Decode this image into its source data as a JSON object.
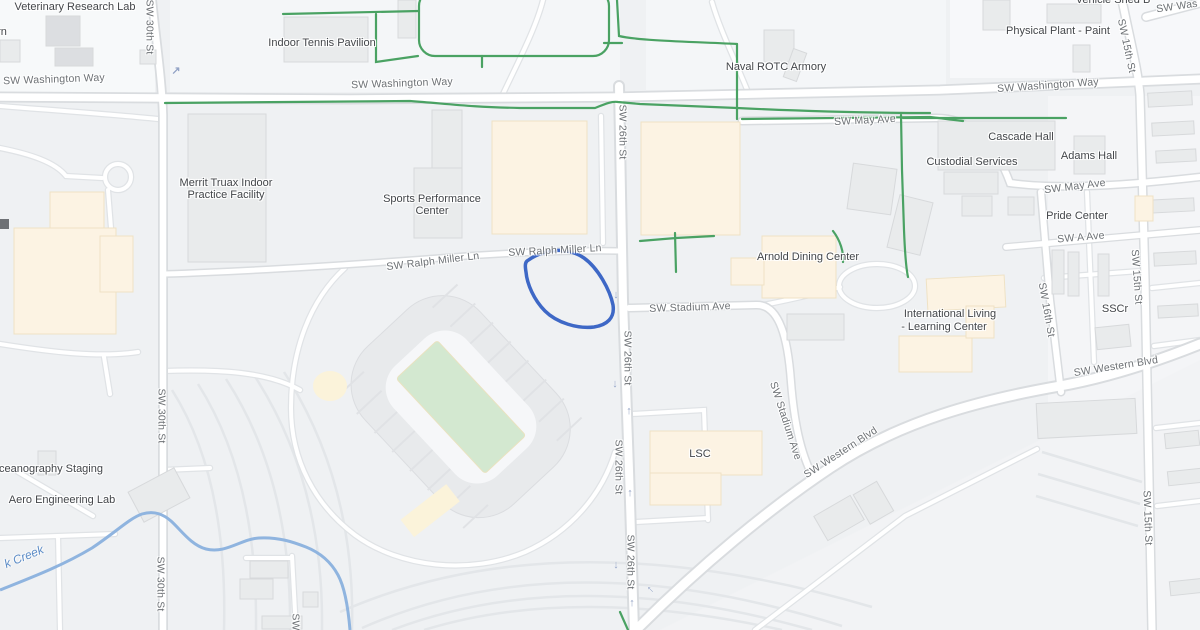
{
  "colors": {
    "background": "#eff1f3",
    "road_fill": "#ffffff",
    "road_casing": "#d9dcdf",
    "building_gray": "#e9ebec",
    "building_peach": "#fcf3e3",
    "bike_path_green": "#4aa263",
    "water_blue": "#8fb4df",
    "route_blue": "#3e68c6",
    "stadium_field_green": "#d3e8d0"
  },
  "roads": {
    "washington_left": "SW Washington Way",
    "washington_center": "SW Washington Way",
    "washington_right": "SW Washington Way",
    "washington_top": "SW Was",
    "may_left": "SW May Ave",
    "may_right": "SW May Ave",
    "a_ave": "SW A Ave",
    "st30_1": "SW 30th St",
    "st30_2": "SW 30th St",
    "st30_3": "SW 30th St",
    "st26_1": "SW 26th St",
    "st26_2": "SW 26th St",
    "st26_3": "SW 26th St",
    "st26_4": "SW 26th St",
    "st15_1": "SW 15th St",
    "st15_2": "SW 15th St",
    "st15_3": "SW 15th St",
    "st16": "SW 16th St",
    "ralph_w": "SW Ralph Miller Ln",
    "ralph_e": "SW Ralph Miller Ln",
    "stadium_h": "SW Stadium Ave",
    "stadium_d": "SW Stadium Ave",
    "western_c": "SW Western Blvd",
    "western_r": "SW Western Blvd",
    "sw_partial": "SW"
  },
  "places": {
    "vet_lab": "Veterinary Research Lab",
    "rn_partial": "rn",
    "tennis": "Indoor Tennis Pavilion",
    "naval": "Naval ROTC Armory",
    "physical_plant": "Physical Plant - Paint",
    "vehicle_shed": "Vehicle Shed B",
    "merrit_1": "Merrit Truax Indoor",
    "merrit_2": "Practice Facility",
    "sports_1": "Sports Performance",
    "sports_2": "Center",
    "arnold": "Arnold Dining Center",
    "cascade": "Cascade Hall",
    "adams": "Adams Hall",
    "custodial": "Custodial Services",
    "pride": "Pride Center",
    "illc_1": "International Living",
    "illc_2": "- Learning Center",
    "sscr": "SSCr",
    "lsc": "LSC",
    "ocean": "ceanography Staging",
    "aero": "Aero Engineering Lab"
  },
  "water": {
    "creek": "k Creek"
  },
  "icons": {
    "up": "↑",
    "down": "↓",
    "turn_ne": "↗"
  }
}
